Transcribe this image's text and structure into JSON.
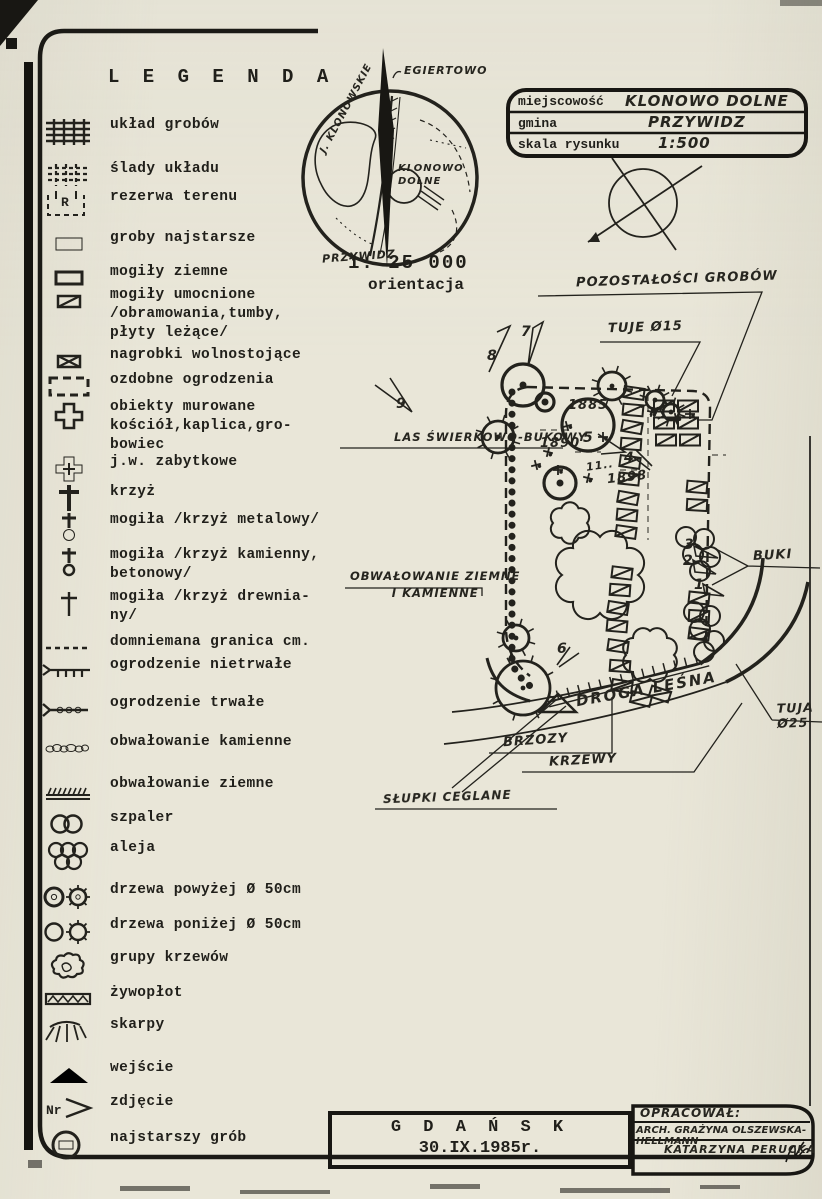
{
  "legend": {
    "title": "L E G E N D A",
    "reserve_letter": "R",
    "photo_nr": "Nr",
    "items": [
      {
        "icon": "grave-grid",
        "label": "układ grobów"
      },
      {
        "icon": "grid-traces",
        "label": "ślady układu"
      },
      {
        "icon": "reserve-area",
        "label": "rezerwa terenu"
      },
      {
        "icon": "oldest-graves",
        "label": "groby najstarsze"
      },
      {
        "icon": "earth-mound-grave",
        "label": "mogiły ziemne"
      },
      {
        "icon": "reinforced-grave",
        "label": "mogiły umocnione\n/obramowania,tumby,\npłyty leżące/"
      },
      {
        "icon": "freestanding-tombstone",
        "label": "nagrobki wolnostojące"
      },
      {
        "icon": "ornamental-fence",
        "label": "ozdobne ogrodzenia"
      },
      {
        "icon": "masonry-object",
        "label": "obiekty murowane\nkościół,kaplica,gro-\nbowiec"
      },
      {
        "icon": "historic-masonry",
        "label": "j.w. zabytkowe"
      },
      {
        "icon": "cross",
        "label": "krzyż"
      },
      {
        "icon": "metal-cross-grave",
        "label": "mogiła /krzyż metalowy/"
      },
      {
        "icon": "stone-cross-grave",
        "label": "mogiła /krzyż kamienny,\nbetonowy/"
      },
      {
        "icon": "wooden-cross-grave",
        "label": "mogiła /krzyż drewnia-\nny/"
      },
      {
        "icon": "presumed-boundary",
        "label": "domniemana granica cm."
      },
      {
        "icon": "temporary-fence",
        "label": "ogrodzenie nietrwałe"
      },
      {
        "icon": "permanent-fence",
        "label": "ogrodzenie trwałe"
      },
      {
        "icon": "stone-embankment",
        "label": "obwałowanie kamienne"
      },
      {
        "icon": "earth-embankment",
        "label": "obwałowanie ziemne"
      },
      {
        "icon": "tree-row",
        "label": "szpaler"
      },
      {
        "icon": "alley",
        "label": "aleja"
      },
      {
        "icon": "trees-over-50cm",
        "label": "drzewa powyżej Ø 50cm"
      },
      {
        "icon": "trees-under-50cm",
        "label": "drzewa poniżej Ø 50cm"
      },
      {
        "icon": "shrub-groups",
        "label": "grupy krzewów"
      },
      {
        "icon": "hedge",
        "label": "żywopłot"
      },
      {
        "icon": "slopes",
        "label": "skarpy"
      },
      {
        "icon": "entrance",
        "label": "wejście"
      },
      {
        "icon": "photo",
        "label": "zdjęcie"
      },
      {
        "icon": "oldest-grave",
        "label": "najstarszy grób"
      }
    ]
  },
  "orientation": {
    "egiertowo": "EGIERTOWO",
    "lake": "J. KLONOWSKIE",
    "village": "KLONOWO\nDOLNE",
    "przywidz": "PRZYWIDZ",
    "scale": "1: 25 000",
    "caption": "orientacja"
  },
  "title_block": {
    "place_label": "miejscowość",
    "place_value": "KLONOWO DOLNE",
    "gmina_label": "gmina",
    "gmina_value": "PRZYWIDZ",
    "scale_label": "skala rysunku",
    "scale_value": "1:500"
  },
  "plan": {
    "labels": {
      "pozostalosci": "POZOSTAŁOŚCI GROBÓW",
      "tuje15": "TUJE Ø15",
      "las": "LAS ŚWIERKOWO-BUKOWY",
      "obwalowanie": "OBWAŁOWANIE ZIEMNE\nI KAMIENNE",
      "buki": "BUKI",
      "droga": "DROGA LEŚNA",
      "tuja25": "TUJA Ø25",
      "brzozy": "BRZOZY",
      "krzewy": "KRZEWY",
      "slupki": "SŁUPKI CEGLANE"
    },
    "years": {
      "a": "1885",
      "b": "1890",
      "c": "1898",
      "d": "11.."
    },
    "markers": {
      "m1": "1",
      "m2": "2",
      "m3": "3",
      "m4": "4",
      "m5": "5",
      "m6": "6",
      "m7": "7",
      "m8": "8",
      "m9": "9"
    }
  },
  "footer": {
    "city": "G D A Ń S K",
    "date": "30.IX.1985r.",
    "credit_header": "OPRACOWAŁ:",
    "credit_line1": "ARCH. GRAŻYNA OLSZEWSKA-HELLMANN",
    "credit_line2": "KATARZYNA PERUCKA"
  },
  "colors": {
    "paper": "#e9e6d8",
    "ink": "#23221d"
  }
}
